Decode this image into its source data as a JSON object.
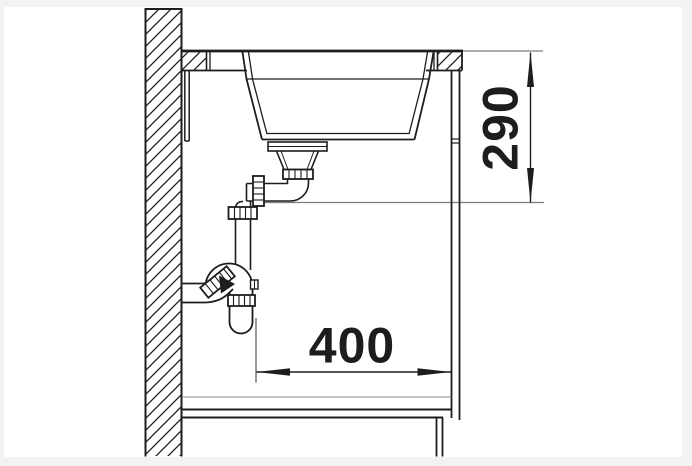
{
  "drawing": {
    "type": "technical-section-drawing",
    "subject": "kitchen-sink installation side section with countertop, cabinet and drain trap",
    "dimensions": [
      {
        "id": "vertical-depth",
        "value": "290",
        "orientation": "vertical",
        "description": "distance from countertop surface down to drain outlet level"
      },
      {
        "id": "horizontal-offset",
        "value": "400",
        "orientation": "horizontal",
        "description": "distance from trap centerline to cabinet right side"
      }
    ],
    "colors": {
      "line": "#1d1d1b",
      "extension_line": "#7d7d7d",
      "paper": "#ffffff",
      "margin": "#f3f3f4",
      "text": "#1d1d1b"
    }
  }
}
